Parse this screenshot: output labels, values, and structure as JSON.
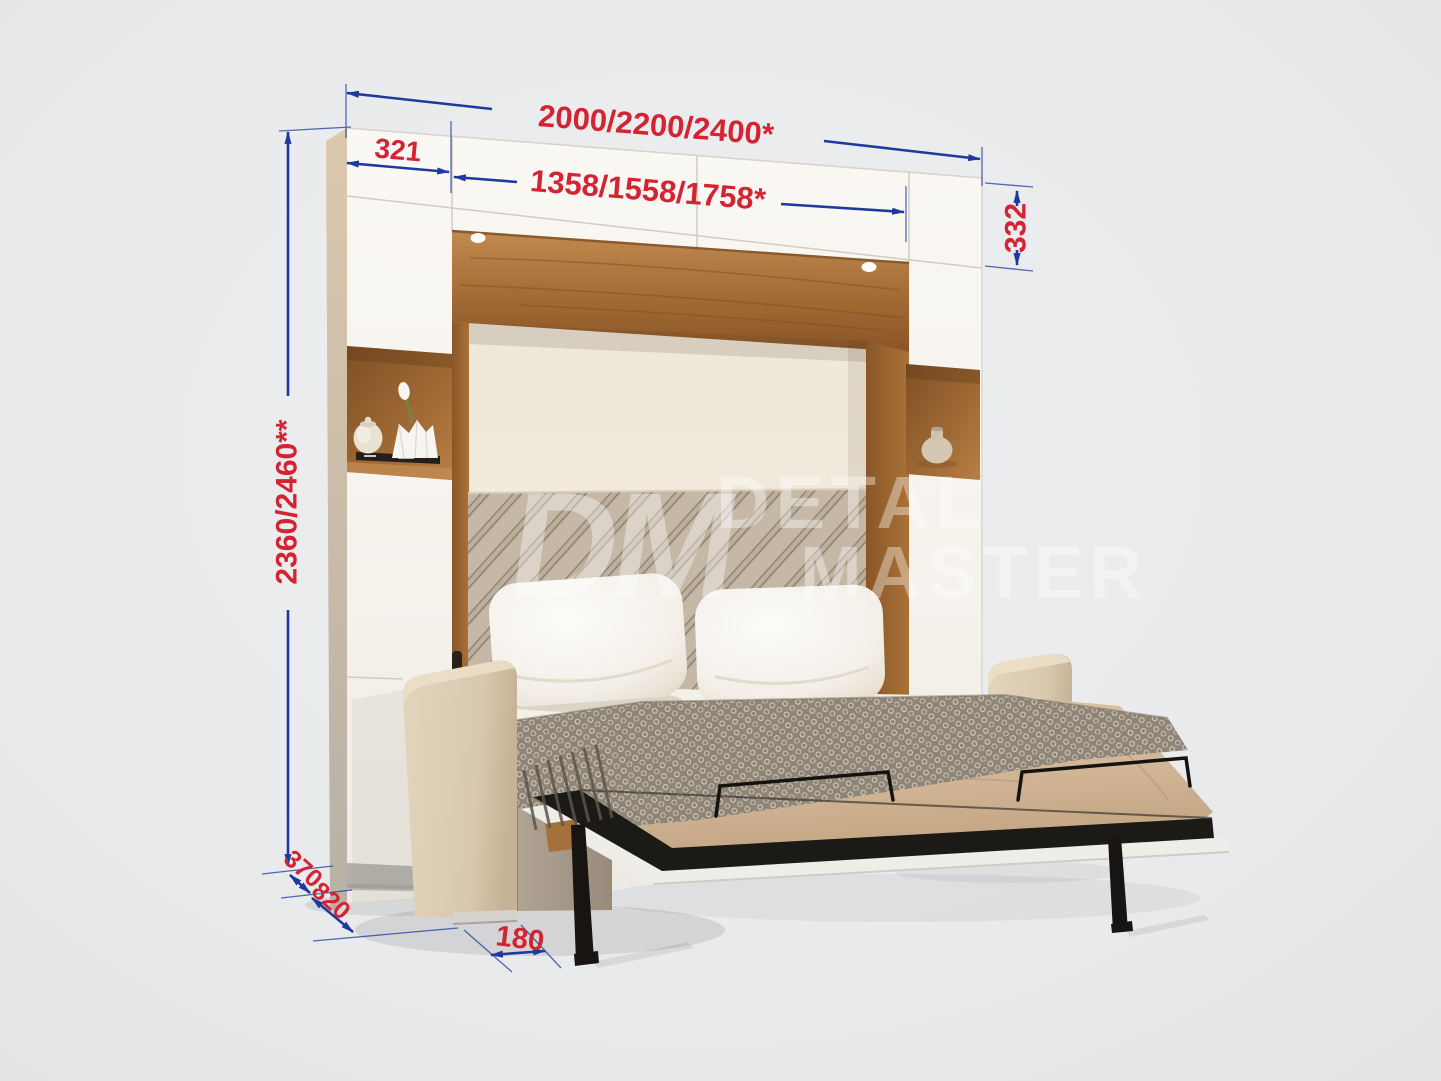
{
  "scene": {
    "background_color": "#e8eaec",
    "colors": {
      "dimension_line": "#1d3a9e",
      "dimension_text": "#d42332",
      "cabinet_white": "#f7f4ef",
      "wood": "#a06a35",
      "upholstery_beige": "#dbcbb2",
      "metal_black": "#1b1917"
    }
  },
  "dimensions": {
    "total_width": "2000/2200/2400*",
    "side_cabinet_width": "321",
    "bed_section_width": "1358/1558/1758*",
    "upper_cabinet_height": "332",
    "total_height": "2360/2460**",
    "cabinet_depth": "370",
    "sofa_depth": "820",
    "support_offset": "180"
  },
  "watermark": {
    "logo": "DM",
    "line1": "DETAL",
    "line2": "MASTER"
  }
}
